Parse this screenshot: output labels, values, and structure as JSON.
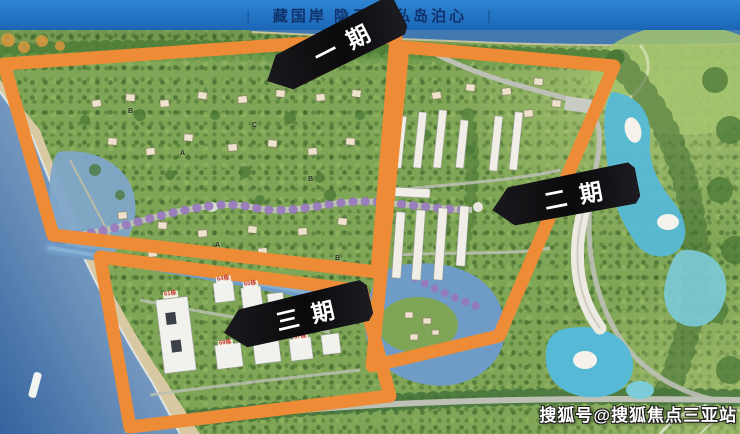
{
  "header": {
    "title": "藏国岸 隐云海 私岛泊心",
    "separator": "|"
  },
  "map": {
    "phase_labels": {
      "phase1": "一期",
      "phase2": "二期",
      "phase3": "三期"
    },
    "building_labels": [
      "61栋",
      "64栋",
      "65栋",
      "69栋",
      "68栋",
      "67栋"
    ],
    "villa_letters": [
      "B",
      "A",
      "C",
      "B",
      "A",
      "B"
    ],
    "colors": {
      "boundary_orange": "#EE8B36",
      "header_blue": "#1E6FC0",
      "header_text": "#10336E",
      "pool_cyan": "#56B9D6",
      "banner_black": "#111111",
      "land_green": "#7FA556",
      "sea_deep": "#35639F",
      "sea_light": "#A6BCCD"
    }
  },
  "watermark": {
    "text": "搜狐号@搜狐焦点三亚站"
  }
}
